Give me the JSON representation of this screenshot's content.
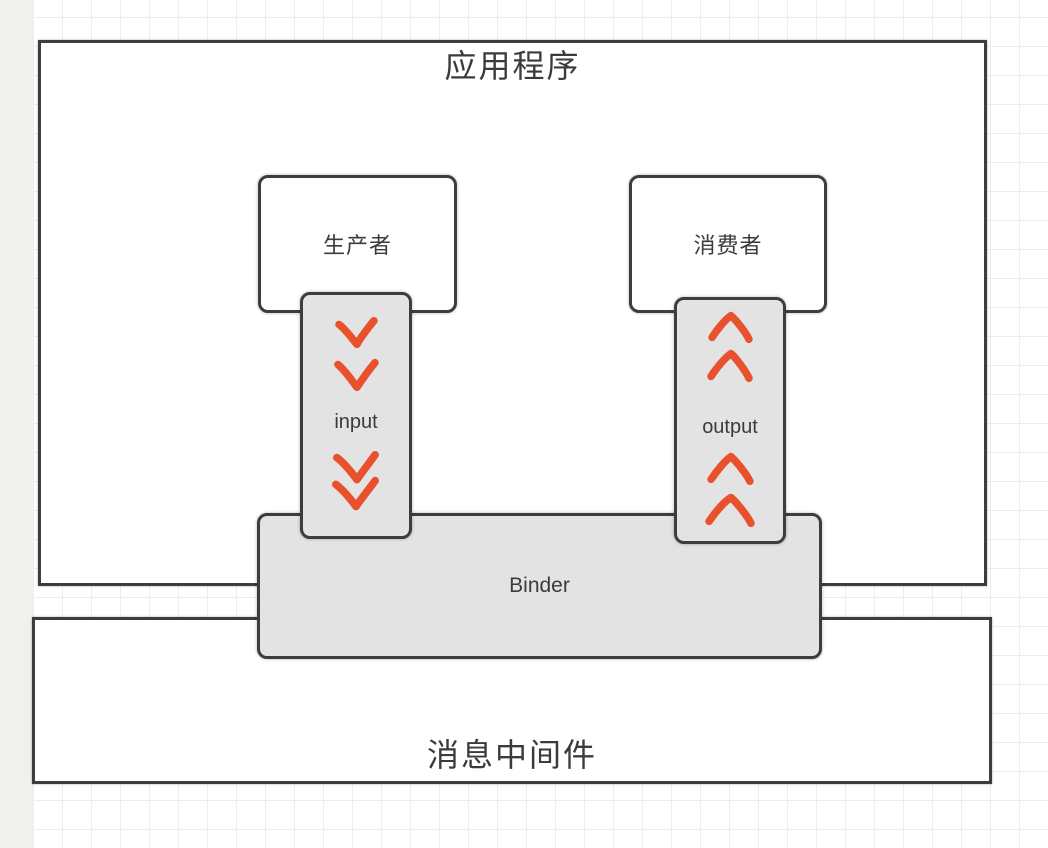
{
  "diagram": {
    "application": {
      "title": "应用程序"
    },
    "producer": {
      "label": "生产者"
    },
    "consumer": {
      "label": "消费者"
    },
    "input_channel": {
      "label": "input",
      "direction": "down"
    },
    "output_channel": {
      "label": "output",
      "direction": "up"
    },
    "binder": {
      "label": "Binder"
    },
    "middleware": {
      "label": "消息中间件"
    }
  },
  "colors": {
    "border": "#3d3d3d",
    "text": "#3b3b3b",
    "channel_fill": "#e3e3e3",
    "arrow": "#e8512c",
    "grid_line": "#ededed",
    "left_strip": "#f0f0ee",
    "box_fill": "#ffffff"
  }
}
